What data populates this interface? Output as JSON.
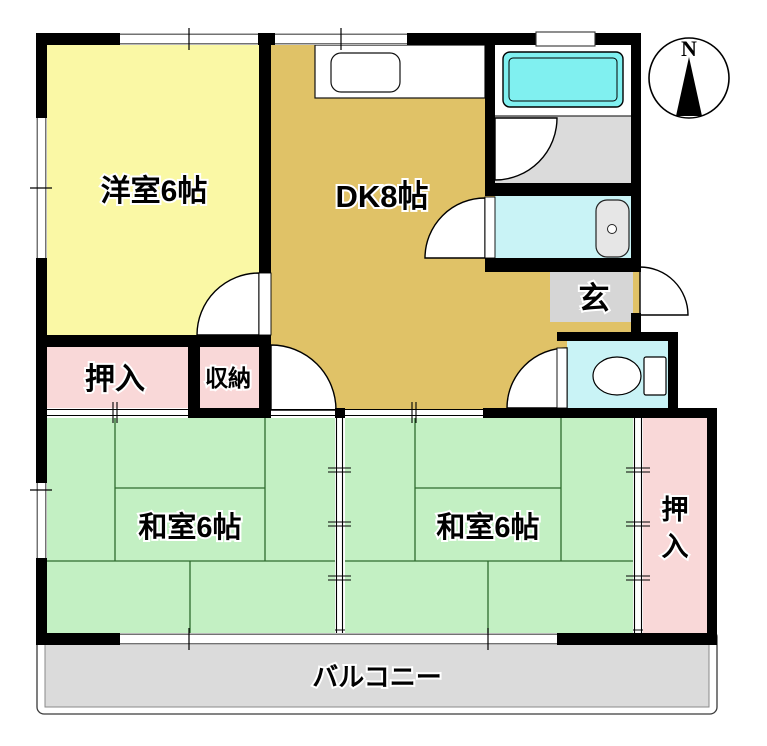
{
  "colors": {
    "wall": "#000000",
    "western_room": "#FAF8A5",
    "dining_kitchen": "#E0C267",
    "tatami_room": "#C3F0C3",
    "tatami_line": "#2E6B2E",
    "closet": "#F9D8D8",
    "bathtub": "#80F0F0",
    "wet_room": "#C9F3F6",
    "dressing_room": "#DBDBDB",
    "entrance_floor": "#D6D6D6",
    "balcony": "#DBDBDB"
  },
  "rooms": {
    "western": {
      "label": "洋室6帖"
    },
    "dk": {
      "label": "DK8帖"
    },
    "tatami_left": {
      "label": "和室6帖"
    },
    "tatami_right": {
      "label": "和室6帖"
    },
    "closet_left": {
      "label": "押入"
    },
    "storage": {
      "label": "収納"
    },
    "entrance": {
      "label": "玄"
    },
    "closet_right": {
      "chars": [
        "押",
        "入"
      ]
    },
    "balcony": {
      "label": "バルコニー"
    }
  },
  "compass": {
    "north_label": "N"
  }
}
